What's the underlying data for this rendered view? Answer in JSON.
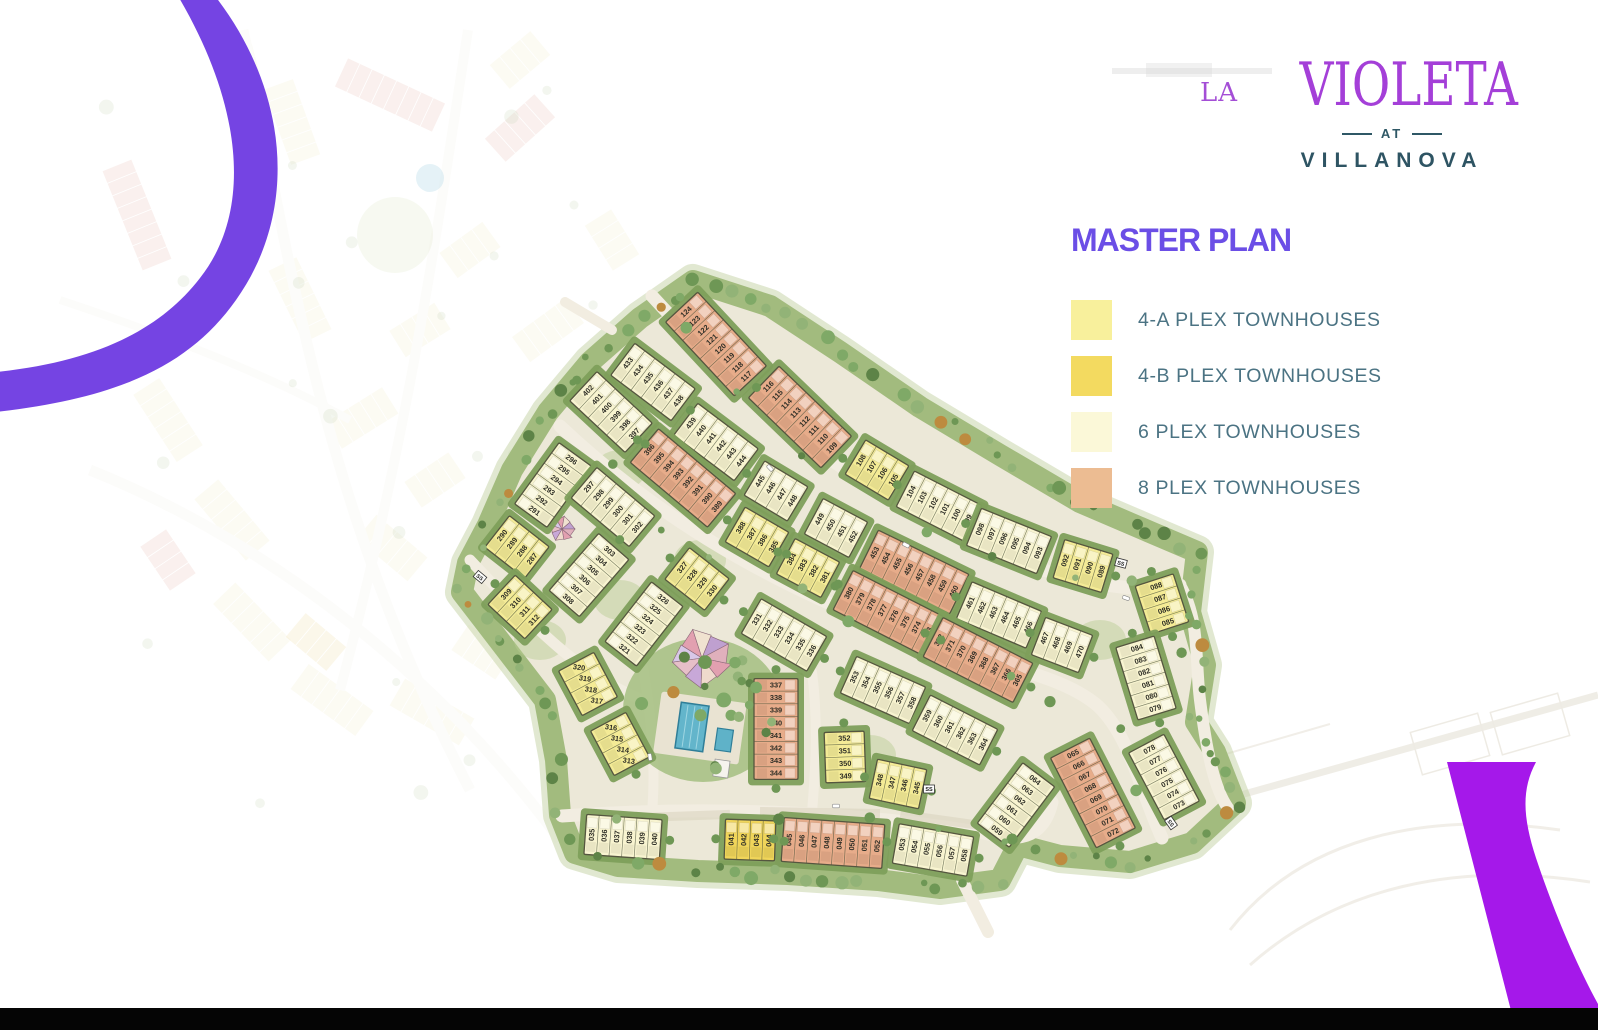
{
  "brand": {
    "la": "LA",
    "violeta": "VIOLETA",
    "at": "AT",
    "villanova": "VILLANOVA"
  },
  "title": "MASTER PLAN",
  "title_color": "#6B4EE6",
  "legend": [
    {
      "key": "4a",
      "label": "4-A PLEX TOWNHOUSES",
      "color": "#F8F09C"
    },
    {
      "key": "4b",
      "label": "4-B PLEX TOWNHOUSES",
      "color": "#F3DA60"
    },
    {
      "key": "6",
      "label": "6 PLEX TOWNHOUSES",
      "color": "#FBF8D8"
    },
    {
      "key": "8",
      "label": "8 PLEX TOWNHOUSES",
      "color": "#ECBC92"
    }
  ],
  "map": {
    "palette": {
      "4a": "#F4EB96",
      "4b": "#F0D55A",
      "6": "#F8F4D0",
      "8": "#E7AC8A",
      "hedge": "#7E9F5B",
      "outline": "#55563F",
      "interior": "#ECE8D8",
      "buffer": "#A2BB7E",
      "road": "#F2EDE1",
      "pool": "#63B5CB",
      "number": "#2E2E26"
    },
    "substation_label": "SS",
    "substations": [
      {
        "x": 480,
        "y": 577,
        "r": 40
      },
      {
        "x": 1121,
        "y": 563,
        "r": 15
      },
      {
        "x": 929,
        "y": 789,
        "r": 0
      },
      {
        "x": 1171,
        "y": 823,
        "r": 55
      }
    ],
    "blocks": [
      {
        "nums": "124-117",
        "t": "8",
        "x": 716,
        "y": 344,
        "a": 47
      },
      {
        "nums": "116-109",
        "t": "8",
        "x": 800,
        "y": 417,
        "a": 44
      },
      {
        "nums": "108-105",
        "t": "4a",
        "x": 877,
        "y": 470,
        "a": 31
      },
      {
        "nums": "104-099",
        "t": "6",
        "x": 939,
        "y": 506,
        "a": 27
      },
      {
        "nums": "098-093",
        "t": "6",
        "x": 1009,
        "y": 541,
        "a": 22
      },
      {
        "nums": "092-089",
        "t": "4a",
        "x": 1083,
        "y": 566,
        "a": 17
      },
      {
        "nums": "088-085",
        "t": "4a",
        "x": 1162,
        "y": 604,
        "a": 72
      },
      {
        "nums": "084-079",
        "t": "6",
        "x": 1146,
        "y": 678,
        "a": 73
      },
      {
        "nums": "078-073",
        "t": "6",
        "x": 1164,
        "y": 777,
        "a": 62
      },
      {
        "nums": "065-072",
        "t": "8",
        "x": 1093,
        "y": 793,
        "a": 63
      },
      {
        "nums": "433-438",
        "t": "6",
        "x": 653,
        "y": 382,
        "a": 37
      },
      {
        "nums": "439-444",
        "t": "6",
        "x": 716,
        "y": 442,
        "a": 37
      },
      {
        "nums": "445-448",
        "t": "6",
        "x": 776,
        "y": 491,
        "a": 31
      },
      {
        "nums": "449-452",
        "t": "6",
        "x": 836,
        "y": 528,
        "a": 28
      },
      {
        "nums": "453-460",
        "t": "8",
        "x": 914,
        "y": 572,
        "a": 26
      },
      {
        "nums": "461-466",
        "t": "6",
        "x": 999,
        "y": 615,
        "a": 23
      },
      {
        "nums": "467-470",
        "t": "6",
        "x": 1062,
        "y": 645,
        "a": 21
      },
      {
        "nums": "402-397",
        "t": "6",
        "x": 611,
        "y": 412,
        "a": 43
      },
      {
        "nums": "396-389",
        "t": "8",
        "x": 683,
        "y": 478,
        "a": 40
      },
      {
        "nums": "291-296",
        "t": "6",
        "x": 553,
        "y": 485,
        "a": -54
      },
      {
        "nums": "297-302",
        "t": "6",
        "x": 613,
        "y": 507,
        "a": 40
      },
      {
        "nums": "290-287",
        "t": "4a",
        "x": 517,
        "y": 547,
        "a": 38
      },
      {
        "nums": "308-303",
        "t": "6",
        "x": 589,
        "y": 575,
        "a": -49
      },
      {
        "nums": "309-312",
        "t": "4a",
        "x": 520,
        "y": 607,
        "a": 43
      },
      {
        "nums": "321-326",
        "t": "6",
        "x": 644,
        "y": 624,
        "a": -52
      },
      {
        "nums": "327-330",
        "t": "4a",
        "x": 697,
        "y": 579,
        "a": 38
      },
      {
        "nums": "388-385",
        "t": "4a",
        "x": 757,
        "y": 537,
        "a": 30
      },
      {
        "nums": "384-381",
        "t": "4a",
        "x": 808,
        "y": 568,
        "a": 28
      },
      {
        "nums": "380-373",
        "t": "8",
        "x": 888,
        "y": 613,
        "a": 27
      },
      {
        "nums": "372-365",
        "t": "8",
        "x": 978,
        "y": 660,
        "a": 27
      },
      {
        "nums": "331-336",
        "t": "6",
        "x": 784,
        "y": 635,
        "a": 30
      },
      {
        "nums": "353-358",
        "t": "6",
        "x": 883,
        "y": 690,
        "a": 24
      },
      {
        "nums": "359-364",
        "t": "6",
        "x": 955,
        "y": 730,
        "a": 27
      },
      {
        "nums": "337-344",
        "t": "8",
        "x": 776,
        "y": 729,
        "a": 90
      },
      {
        "nums": "352-349",
        "t": "4a",
        "x": 845,
        "y": 757,
        "a": 88
      },
      {
        "nums": "348-345",
        "t": "4a",
        "x": 898,
        "y": 784,
        "a": 12
      },
      {
        "nums": "320-317",
        "t": "4a",
        "x": 588,
        "y": 684,
        "a": 62,
        "nr": 8
      },
      {
        "nums": "316-313",
        "t": "4a",
        "x": 620,
        "y": 744,
        "a": 62,
        "nr": 8
      },
      {
        "nums": "035-040",
        "t": "6",
        "x": 623,
        "y": 837,
        "a": 4
      },
      {
        "nums": "041-044",
        "t": "4b",
        "x": 750,
        "y": 840,
        "a": 2
      },
      {
        "nums": "045-052",
        "t": "8",
        "x": 833,
        "y": 843,
        "a": 4
      },
      {
        "nums": "053-058",
        "t": "6",
        "x": 933,
        "y": 850,
        "a": 10
      },
      {
        "nums": "059-064",
        "t": "6",
        "x": 1016,
        "y": 805,
        "a": -53
      }
    ]
  },
  "accents": {
    "arc_top_left": "#7544E3",
    "arc_bottom_right": "#A518EA",
    "bottom_bar": "#050505"
  }
}
